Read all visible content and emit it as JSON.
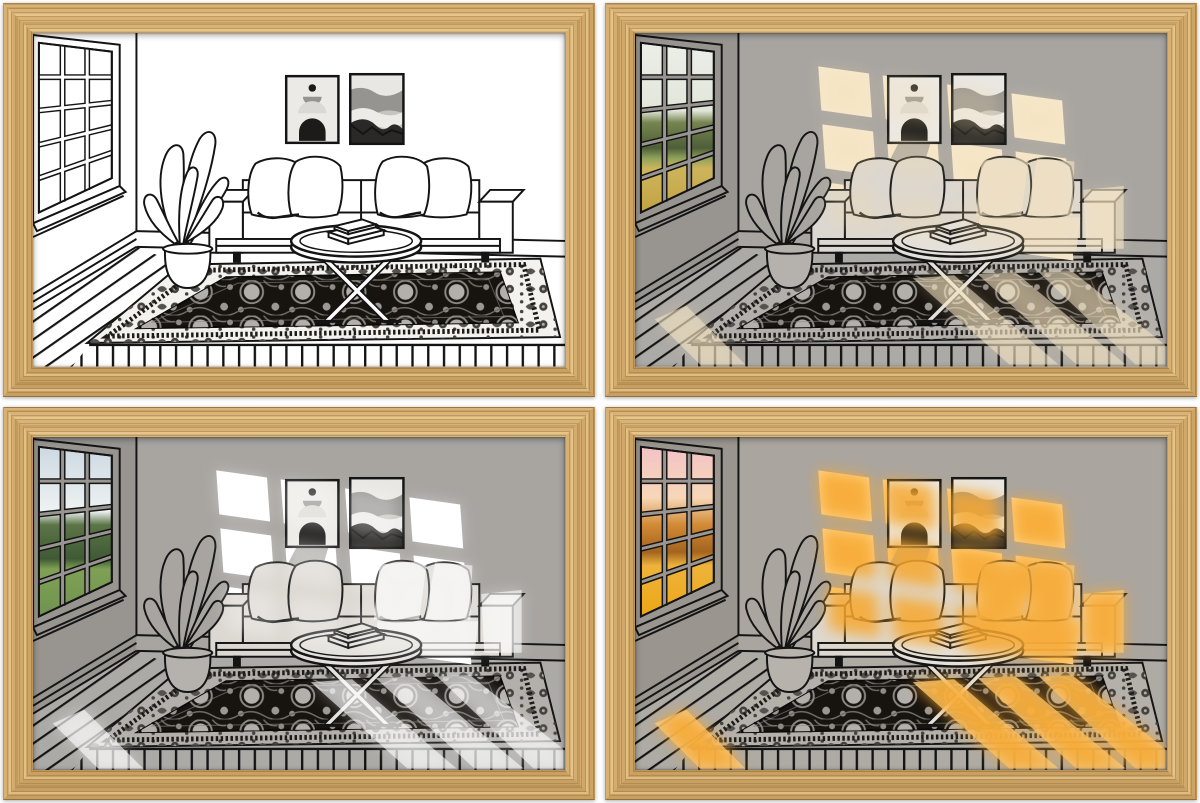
{
  "board": {
    "background": "#ffffff",
    "rows": 2,
    "cols": 2
  },
  "frame": {
    "border_px": 30,
    "palette": {
      "wood": "#d6ab68",
      "woodGrainDark": "#8f6c33",
      "woodGrainLight": "#efd4a0"
    }
  },
  "scene": {
    "subject": "line-art-living-room",
    "elements": [
      "paned-window",
      "potted-plant",
      "two-abstract-posters",
      "sofa-with-four-pillows",
      "round-coffee-table-with-books",
      "oriental-rug",
      "plank-floor"
    ],
    "line_color": "#141414",
    "rug_field": "#17130f",
    "rug_motif_light": "#b3b0ac",
    "rug_motif_dark": "#44413d",
    "poster_dark": "#1c1b1a",
    "poster_mid": "#969491",
    "poster_light": "#e9e7e3"
  },
  "panels": [
    {
      "id": "top-left",
      "lighting": "unlit-line-art",
      "palette": {
        "wall": "#ffffff",
        "wallSide": "#ffffff",
        "floor": "#ffffff",
        "sofa": "#ffffff",
        "leaf": "#ffffff",
        "pot": "#ffffff",
        "table": "#ffffff",
        "rugBorder": "#f3f2ef",
        "pane": "#ffffff",
        "light": "transparent",
        "glowColor": "transparent",
        "glowOp": "0",
        "floorLightOp": "0",
        "sofaLightOp": "0"
      }
    },
    {
      "id": "top-right",
      "lighting": "soft-warm-afternoon-sun",
      "palette": {
        "wall": "#a8a5a1",
        "wallSide": "#989591",
        "floor": "#acaaa6",
        "sofa": "#dbd7d1",
        "leaf": "#a8a5a1",
        "pot": "#b5b2ad",
        "table": "#e4e1dc",
        "rugBorder": "#b3b0ac",
        "pane": "url(#paneDay2)",
        "light": "#f6e9cf",
        "glowColor": "#f3d9a6",
        "glowOp": "0.25",
        "floorLightOp": "0.55",
        "sofaLightOp": "0.6"
      }
    },
    {
      "id": "bottom-left",
      "lighting": "bright-white-daylight",
      "palette": {
        "wall": "#a8a5a1",
        "wallSide": "#989591",
        "floor": "#acaaa6",
        "sofa": "#dbd7d1",
        "leaf": "#a8a5a1",
        "pot": "#b5b2ad",
        "table": "#e4e1dc",
        "rugBorder": "#b3b0ac",
        "pane": "url(#paneDay3)",
        "light": "#ffffff",
        "glowColor": "#ffffff",
        "glowOp": "0.3",
        "floorLightOp": "0.6",
        "sofaLightOp": "0.6"
      }
    },
    {
      "id": "bottom-right",
      "lighting": "golden-sunset",
      "palette": {
        "wall": "#aaa59f",
        "wallSide": "#9a958f",
        "floor": "#aeaaa4",
        "sofa": "#ddd8d0",
        "leaf": "#aaa59f",
        "pot": "#b7b3ac",
        "table": "#e5e1da",
        "rugBorder": "#b4b0aa",
        "pane": "url(#paneSunset)",
        "light": "#ffd58d",
        "glowColor": "#f7a72e",
        "glowOp": "0.85",
        "floorLightOp": "0.8",
        "sofaLightOp": "0.75"
      }
    }
  ]
}
